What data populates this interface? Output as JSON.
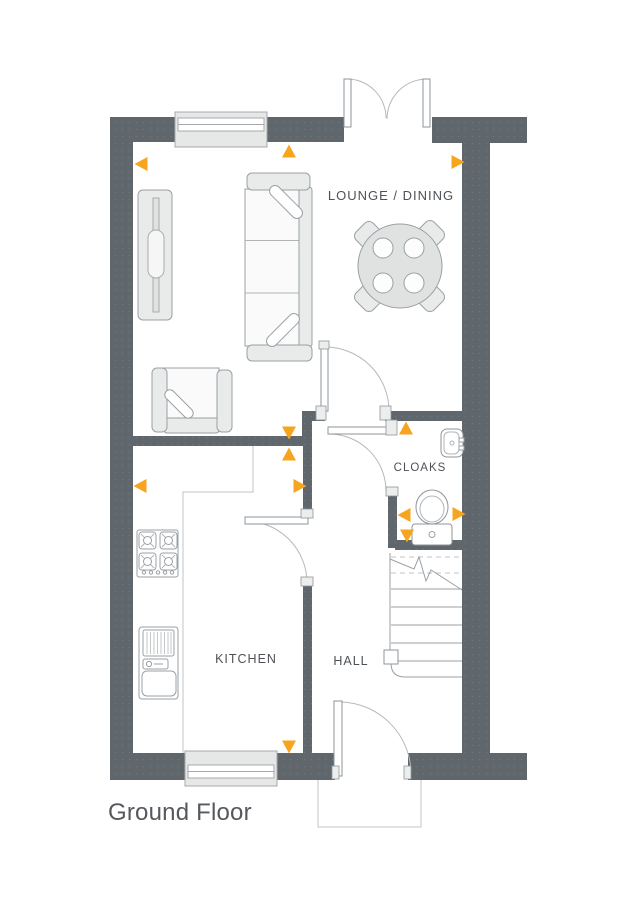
{
  "title": "Ground Floor",
  "rooms": {
    "lounge_dining": "LOUNGE / DINING",
    "cloaks": "CLOAKS",
    "kitchen": "KITCHEN",
    "hall": "HALL"
  },
  "colors": {
    "wall": "#5f666c",
    "accent": "#F7A51F",
    "line": "#9aa0a4",
    "text": "#4d5156"
  },
  "markers": [
    {
      "dir": "left",
      "x": 141,
      "y": 164
    },
    {
      "dir": "up",
      "x": 289,
      "y": 151
    },
    {
      "dir": "right",
      "x": 458,
      "y": 162
    },
    {
      "dir": "down",
      "x": 289,
      "y": 433
    },
    {
      "dir": "up",
      "x": 289,
      "y": 454
    },
    {
      "dir": "left",
      "x": 140,
      "y": 486
    },
    {
      "dir": "right",
      "x": 300,
      "y": 486
    },
    {
      "dir": "up",
      "x": 406,
      "y": 428
    },
    {
      "dir": "left",
      "x": 404,
      "y": 515
    },
    {
      "dir": "right",
      "x": 459,
      "y": 514
    },
    {
      "dir": "down",
      "x": 407,
      "y": 536
    },
    {
      "dir": "down",
      "x": 289,
      "y": 747
    }
  ]
}
